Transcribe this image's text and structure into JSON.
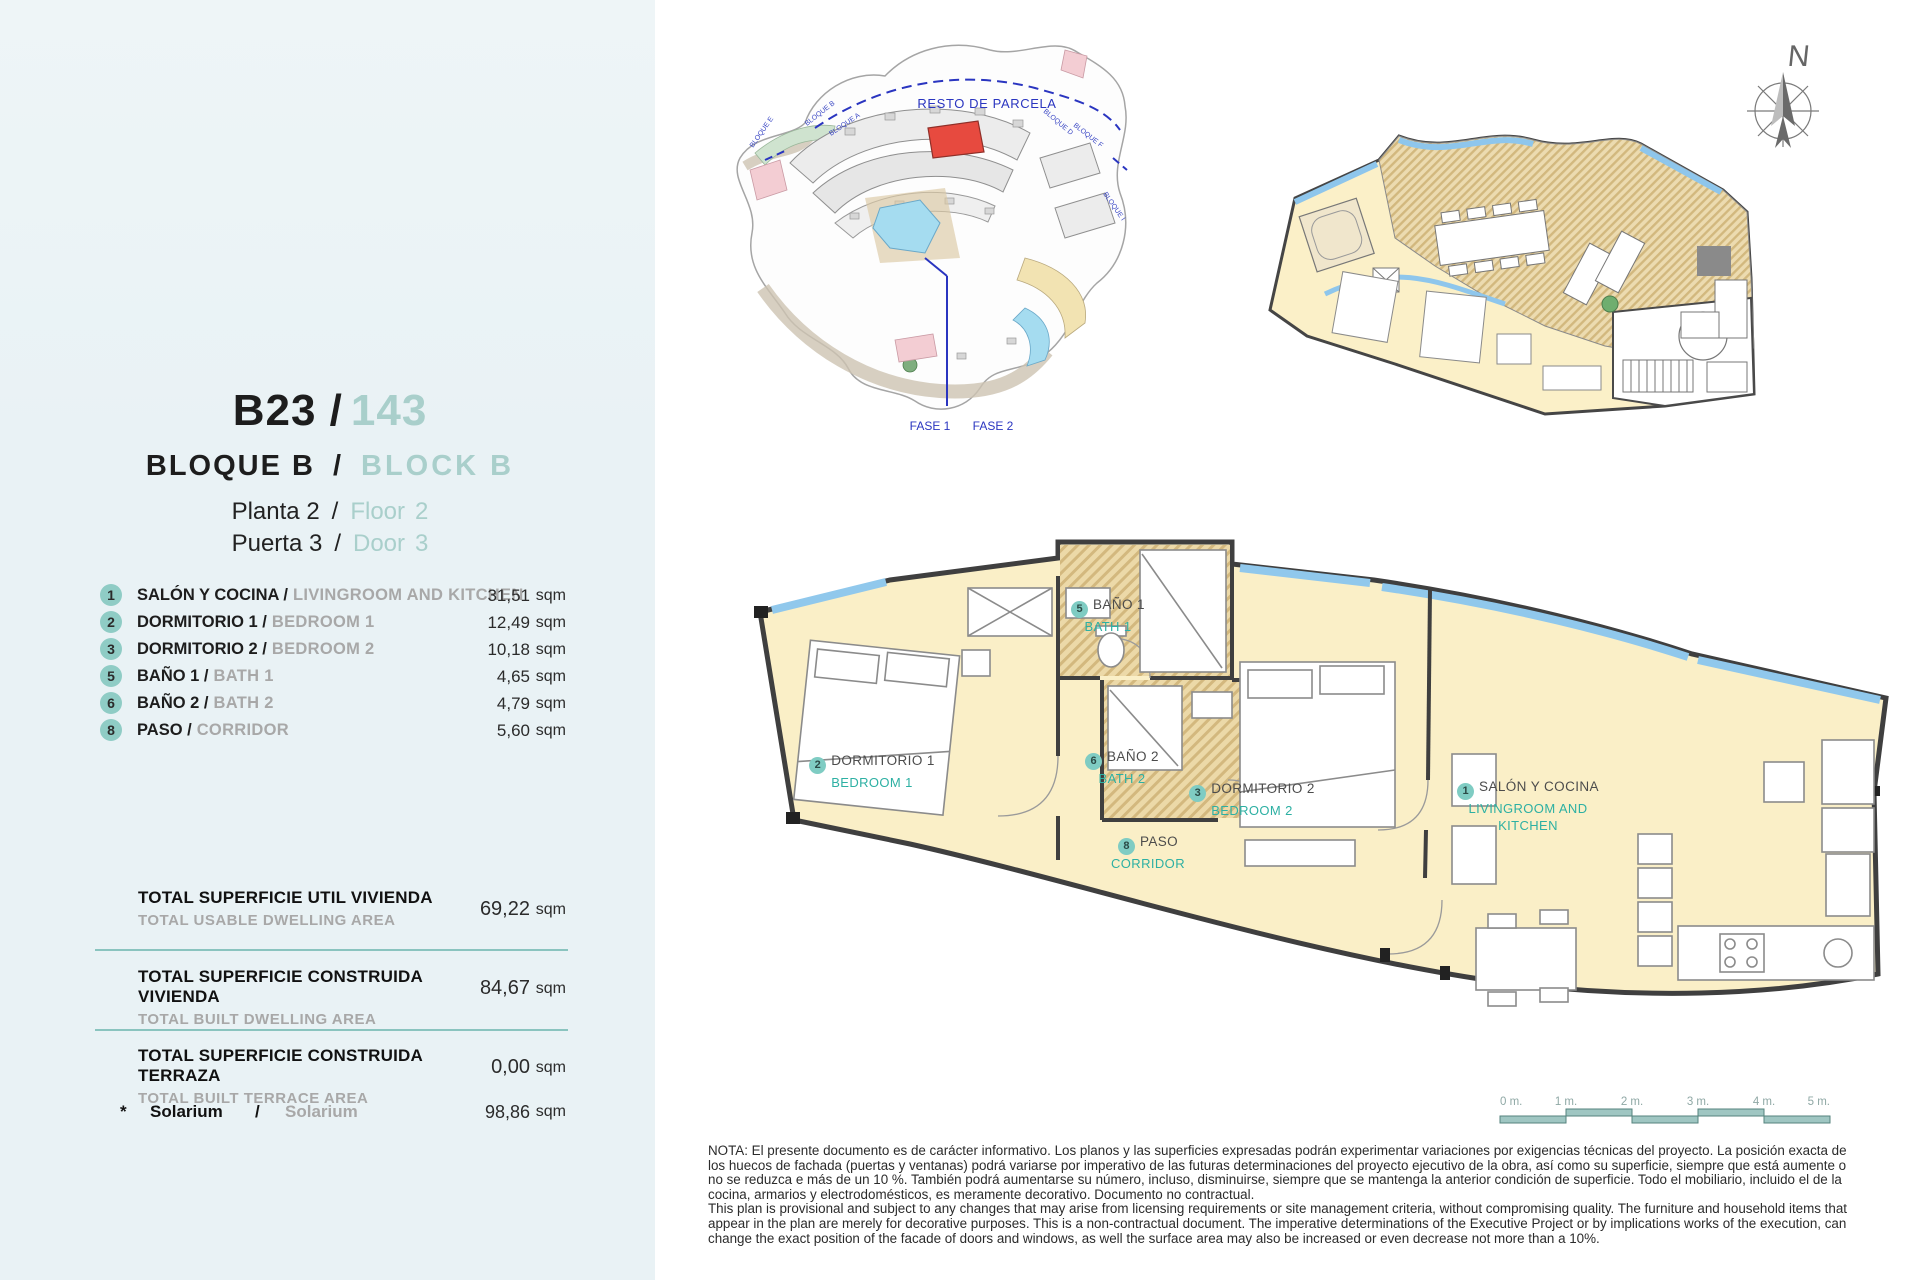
{
  "sidebar": {
    "unit": {
      "code": "B23 /",
      "number": "143"
    },
    "block": {
      "es": "BLOQUE B",
      "sep": "/",
      "en": "BLOCK B"
    },
    "floor": {
      "es": "Planta 2",
      "sep": "/",
      "en_label": "Floor",
      "en_value": "2"
    },
    "door": {
      "es": "Puerta 3",
      "sep": "/",
      "en_label": "Door",
      "en_value": "3"
    },
    "rooms": [
      {
        "num": "1",
        "es": "SALÓN Y COCINA /",
        "en": "LIVINGROOM AND KITCHEN",
        "area": "31,51",
        "unit": "sqm"
      },
      {
        "num": "2",
        "es": "DORMITORIO 1 /",
        "en": "BEDROOM 1",
        "area": "12,49",
        "unit": "sqm"
      },
      {
        "num": "3",
        "es": "DORMITORIO 2 /",
        "en": "BEDROOM 2",
        "area": "10,18",
        "unit": "sqm"
      },
      {
        "num": "5",
        "es": "BAÑO 1 /",
        "en": "BATH 1",
        "area": "4,65",
        "unit": "sqm"
      },
      {
        "num": "6",
        "es": "BAÑO 2 /",
        "en": "BATH 2",
        "area": "4,79",
        "unit": "sqm"
      },
      {
        "num": "8",
        "es": "PASO /",
        "en": "CORRIDOR",
        "area": "5,60",
        "unit": "sqm"
      }
    ],
    "totals": [
      {
        "es": "TOTAL SUPERFICIE UTIL VIVIENDA",
        "en": "TOTAL USABLE DWELLING AREA",
        "value": "69,22",
        "unit": "sqm"
      },
      {
        "es": "TOTAL SUPERFICIE CONSTRUIDA VIVIENDA",
        "en": "TOTAL BUILT DWELLING AREA",
        "value": "84,67",
        "unit": "sqm"
      },
      {
        "es": "TOTAL SUPERFICIE CONSTRUIDA TERRAZA",
        "en": "TOTAL BUILT TERRACE AREA",
        "value": "0,00",
        "unit": "sqm"
      }
    ],
    "solarium": {
      "star": "*",
      "es": "Solarium",
      "sep": "/",
      "en": "Solarium",
      "value": "98,86",
      "unit": "sqm"
    }
  },
  "site_plan": {
    "resto": "RESTO DE PARCELA",
    "fase1": "FASE 1",
    "fase2": "FASE 2",
    "blocks": [
      "BLOQUE E",
      "BLOQUE B",
      "BLOQUE A",
      "BLOQUE D",
      "BLOQUE F",
      "BLOQUE I"
    ]
  },
  "compass": {
    "n": "N"
  },
  "plan_labels": {
    "bath1": {
      "num": "5",
      "es": "BAÑO 1",
      "en": "BATH 1"
    },
    "bedroom1": {
      "num": "2",
      "es": "DORMITORIO 1",
      "en": "BEDROOM 1"
    },
    "bath2": {
      "num": "6",
      "es": "BAÑO 2",
      "en": "BATH 2"
    },
    "bedroom2": {
      "num": "3",
      "es": "DORMITORIO 2",
      "en": "BEDROOM 2"
    },
    "corridor": {
      "num": "8",
      "es": "PASO",
      "en": "CORRIDOR"
    },
    "living": {
      "num": "1",
      "es": "SALÓN Y COCINA",
      "en_line1": "LIVINGROOM AND",
      "en_line2": "KITCHEN"
    }
  },
  "scale": {
    "labels": [
      "0 m.",
      "1 m.",
      "2 m.",
      "3 m.",
      "4 m.",
      "5 m."
    ]
  },
  "note": {
    "es": "NOTA: El presente documento es de carácter informativo. Los planos y las superficies expresadas podrán experimentar variaciones por exigencias técnicas del proyecto. La posición exacta de los huecos de fachada (puertas y ventanas) podrá variarse por imperativo de las futuras determinaciones del proyecto ejecutivo de la obra, así como su superficie, siempre que está aumente o no se reduzca e más de un 10 %. También podrá aumentarse su número, incluso, disminuirse, siempre que se mantenga la anterior condición de superficie. Todo el mobiliario, incluido el de la cocina, armarios y electrodomésticos, es meramente decorativo. Documento no contractual.",
    "en": "This plan is provisional and subject to any changes that may arise from licensing requirements or site management criteria, without compromising quality. The furniture and household items that appear in the plan are merely for decorative purposes. This is a non-contractual document. The imperative determinations of the Executive Project or by implications works of the execution, can change the exact position of the facade of doors and windows, as well the surface area may also be increased or even decrease not more than a 10%."
  },
  "colors": {
    "sidebar_bg": "#e9f2f5",
    "accent_teal": "#8fccc5",
    "label_teal": "#2db0a3",
    "header_teal": "#a9cfcb",
    "highlight_red": "#e74a3f",
    "plan_yellow": "#faefc7",
    "site_blue": "#2a35c0"
  }
}
